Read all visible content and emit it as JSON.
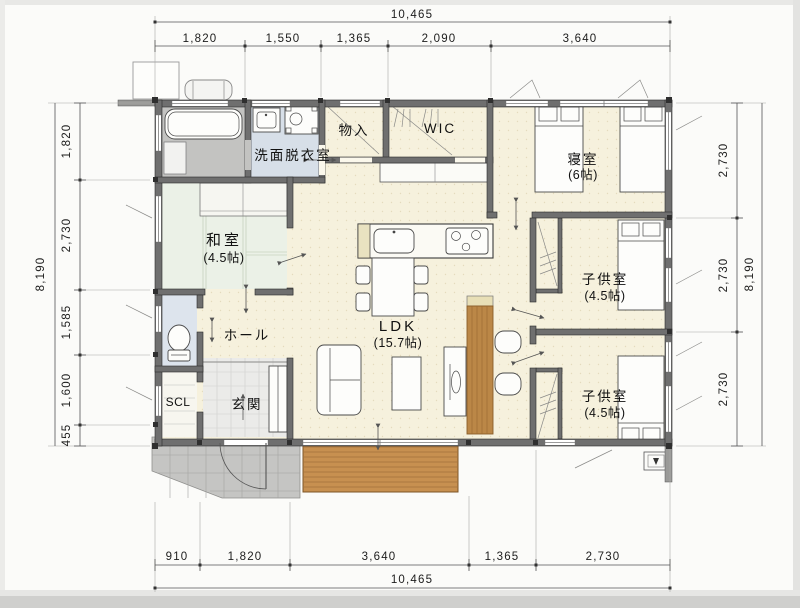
{
  "dimensions": {
    "top": {
      "total": "10,465",
      "segments": [
        "1,820",
        "1,550",
        "1,365",
        "2,090",
        "3,640"
      ]
    },
    "bottom": {
      "total": "10,465",
      "segments": [
        "910",
        "1,820",
        "3,640",
        "1,365",
        "2,730"
      ]
    },
    "left": {
      "total": "8,190",
      "segments": [
        "1,820",
        "2,730",
        "1,585",
        "1,600",
        "455"
      ]
    },
    "right": {
      "total": "8,190",
      "segments": [
        "2,730",
        "2,730",
        "2,730"
      ]
    }
  },
  "rooms": {
    "washroom": {
      "label": "洗面脱衣室"
    },
    "storage": {
      "label": "物入"
    },
    "wic": {
      "label": "WIC"
    },
    "bedroom": {
      "label": "寝室",
      "size": "(6帖)"
    },
    "japanese_room": {
      "label": "和室",
      "size": "(4.5帖)"
    },
    "ldk": {
      "label": "LDK",
      "size": "(15.7帖)"
    },
    "hall": {
      "label": "ホール"
    },
    "kids_room_1": {
      "label": "子供室",
      "size": "(4.5帖)"
    },
    "kids_room_2": {
      "label": "子供室",
      "size": "(4.5帖)"
    },
    "scl": {
      "label": "SCL"
    },
    "entrance": {
      "label": "玄関"
    }
  },
  "colors": {
    "floor": "#f6f1dd",
    "tatami": "#ebf1e7",
    "wet_floor": "#d7dfe8",
    "bath_floor": "#c3c3c1",
    "wall": "#6f6f6f",
    "deck": "#c79050",
    "porch_tile": "#c5c5c3",
    "wood_counter": "#bb8747"
  }
}
